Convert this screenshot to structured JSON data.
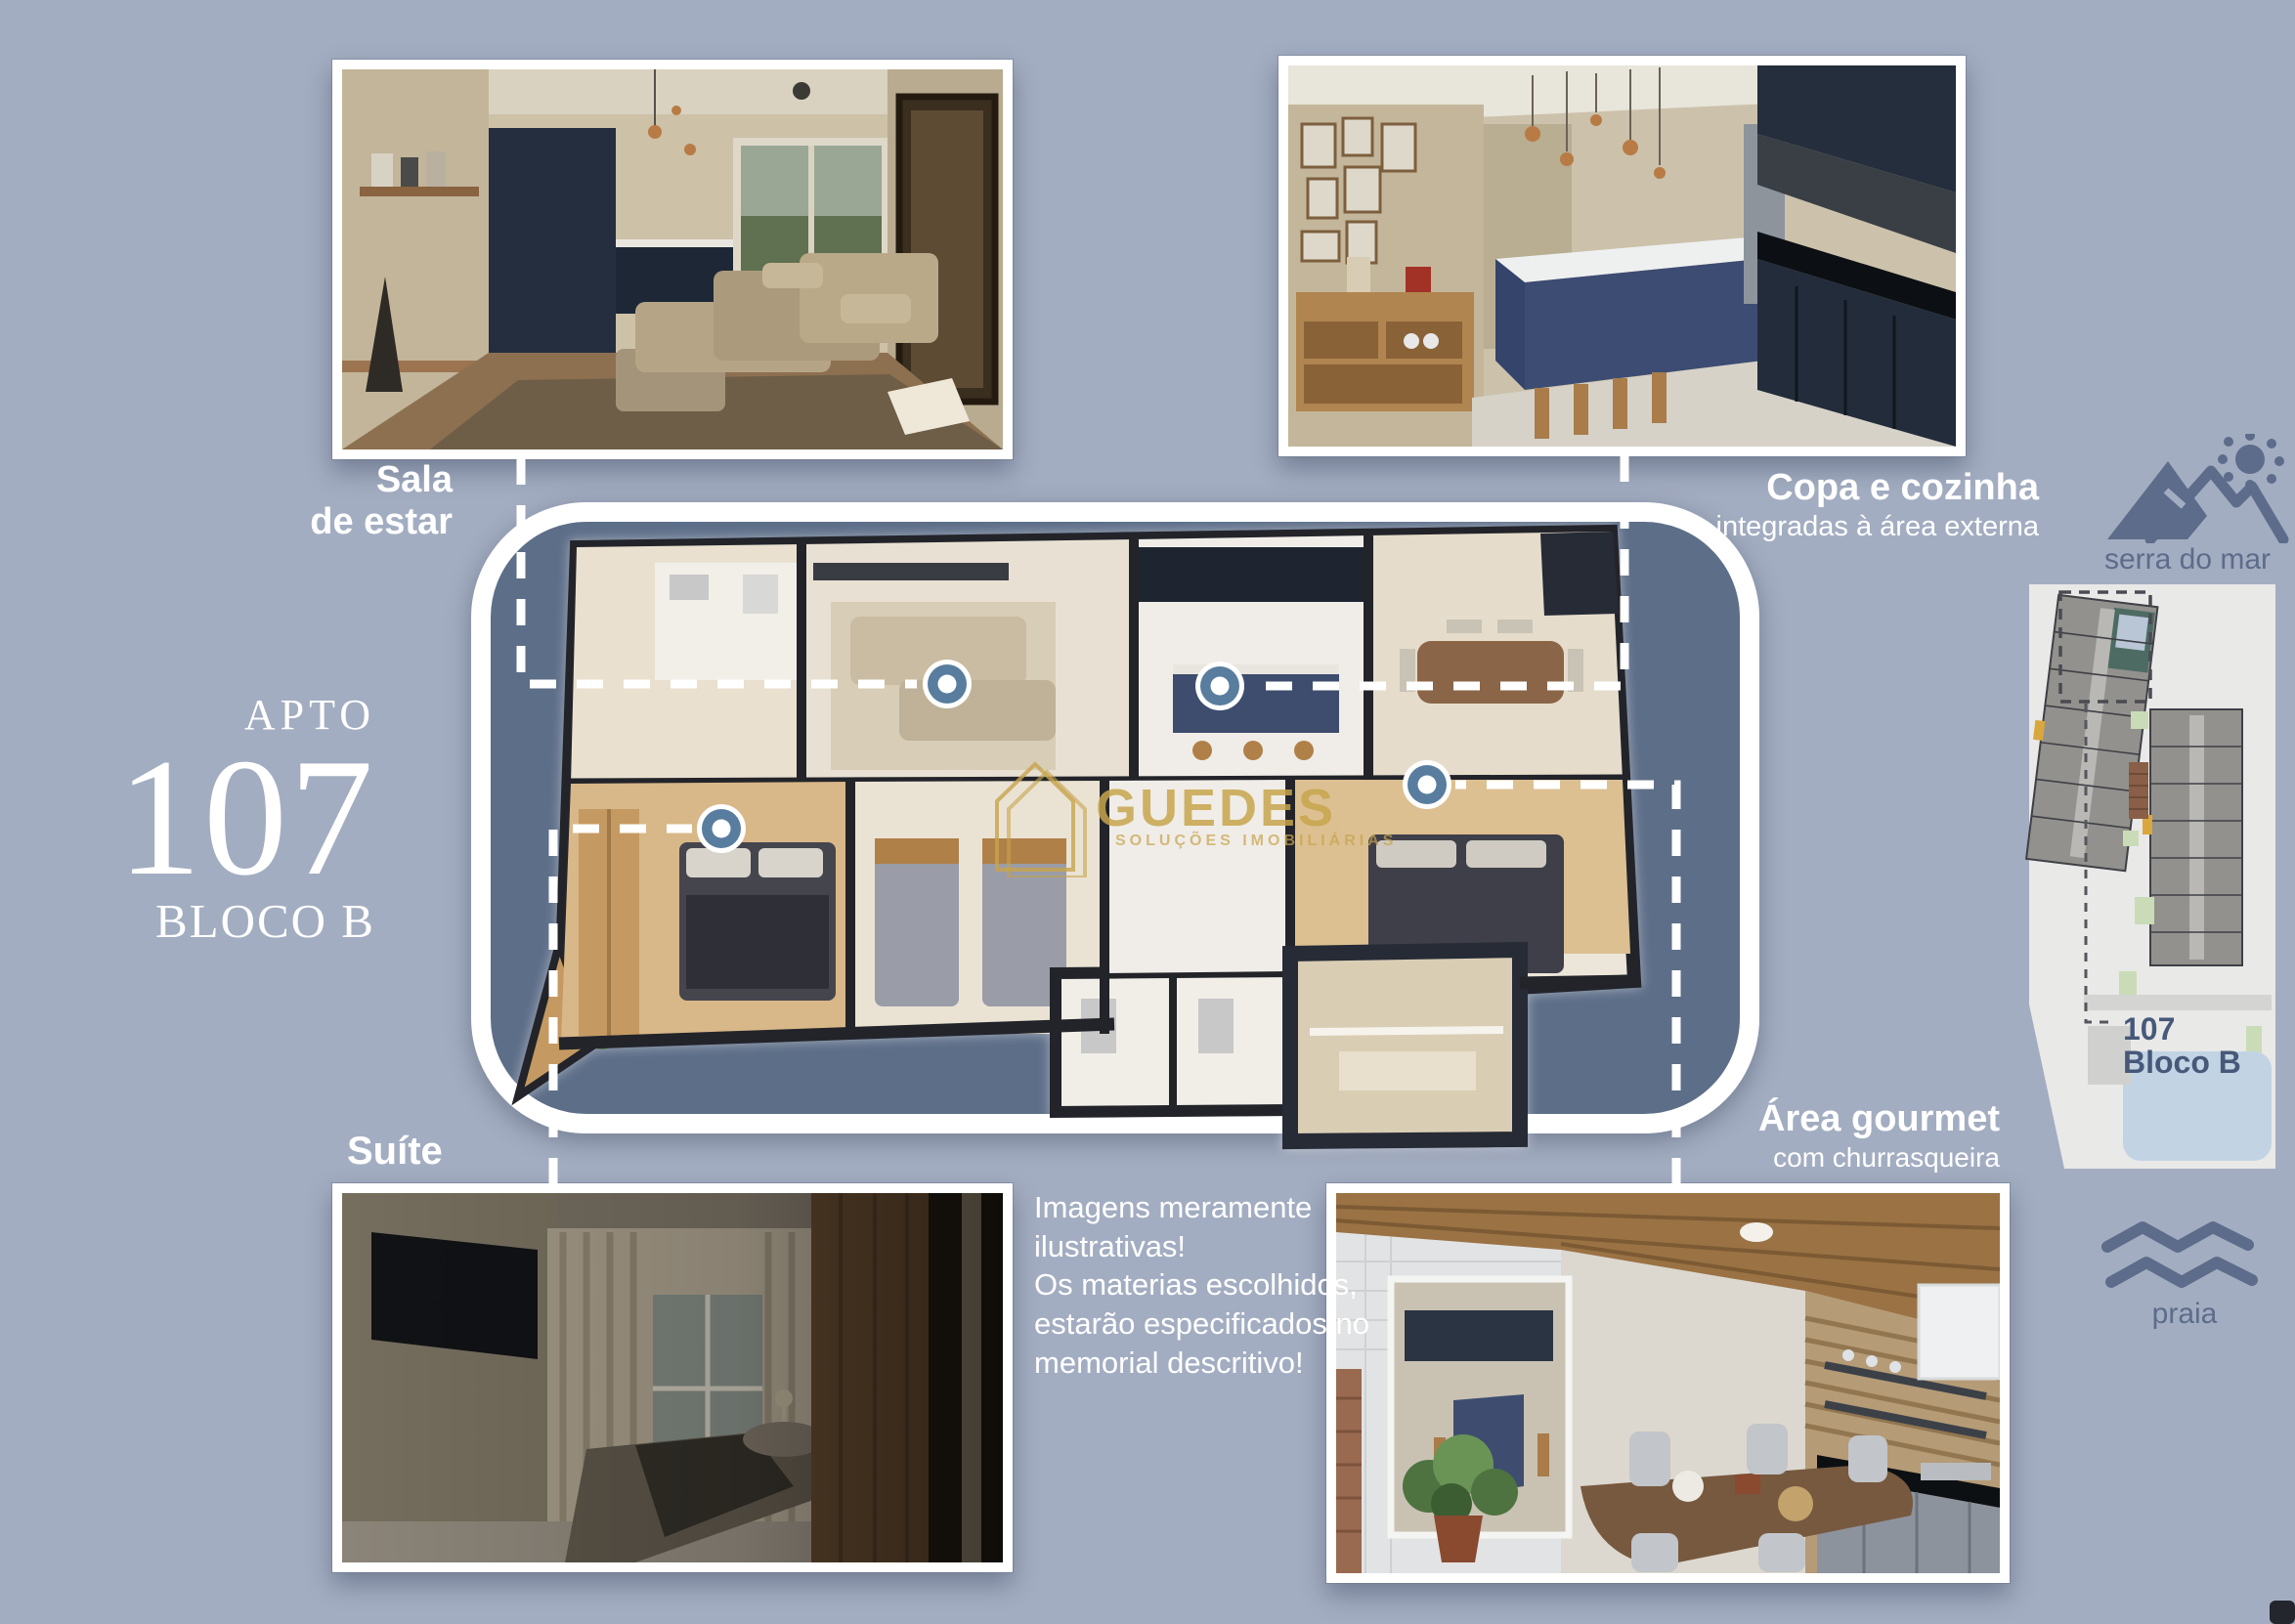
{
  "page": {
    "background": "#a3adc1"
  },
  "apartment": {
    "label": "APTO",
    "number": "107",
    "block": "BLOCO B"
  },
  "photo_labels": {
    "sala": {
      "line1": "Sala",
      "line2": "de estar"
    },
    "copa": {
      "title": "Copa e cozinha",
      "subtitle": "integradas à área externa"
    },
    "suite": {
      "title": "Suíte"
    },
    "gourmet": {
      "title": "Área gourmet",
      "subtitle": "com churrasqueira"
    }
  },
  "disclaimer": "Imagens meramente\nilustrativas!\nOs materias escolhidos,\nestarão especificados no\nmemorial descritivo!",
  "watermark": {
    "name": "GUEDES",
    "tagline": "SOLUÇÕES IMOBILIÁRIAS"
  },
  "landmarks": {
    "serra": "serra do mar",
    "praia": "praia"
  },
  "siteplan": {
    "unit": "107",
    "block": "Bloco B"
  },
  "colors": {
    "background": "#a3adc1",
    "panel": "#5d6e88",
    "marker": "#587d9e",
    "gold": "#c6a050",
    "icon": "#5d6c8a",
    "siteplan_label": "#47597a"
  }
}
